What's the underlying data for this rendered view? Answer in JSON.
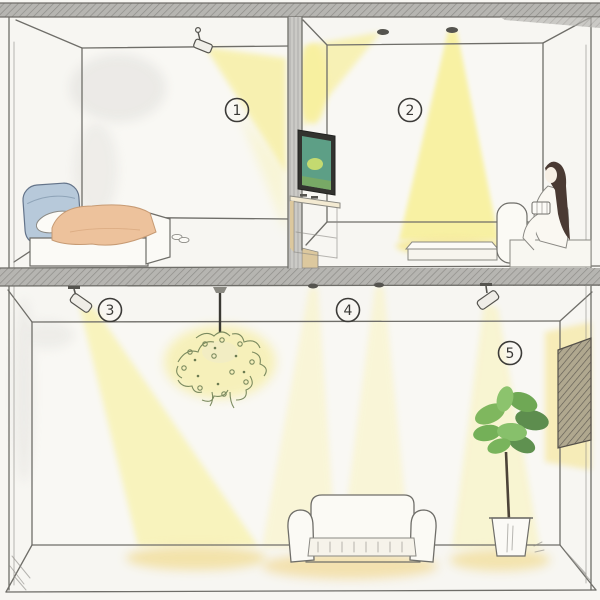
{
  "callouts": [
    {
      "id": "1",
      "text": "1"
    },
    {
      "id": "2",
      "text": "2"
    },
    {
      "id": "3",
      "text": "3"
    },
    {
      "id": "4",
      "text": "4"
    },
    {
      "id": "5",
      "text": "5"
    }
  ],
  "palette": {
    "background": "#f7f6f2",
    "wall_white": "#f9f8f4",
    "pencil_line": "#6f6e69",
    "structure_hatch_gray": "#b6b5b1",
    "light_beam_yellow": "#f8f09e",
    "floor_glow": "#f2df9e",
    "headboard_blue": "#b7c9da",
    "blanket_peach": "#edc29c",
    "plant_green": "#7ab35c",
    "tv_screen_teal": "#5d9f86",
    "hair_dark_brown": "#4a3a33",
    "wood_tan": "#dcc89e"
  },
  "scene_objects": [
    "wall-spotlight",
    "bed",
    "slippers",
    "ceiling-downlights",
    "tv",
    "tv-console",
    "coffee-table",
    "person-on-sofa",
    "track-spotlight",
    "pendant-foliage-chandelier",
    "living-sofa",
    "potted-plant",
    "wall-art"
  ]
}
